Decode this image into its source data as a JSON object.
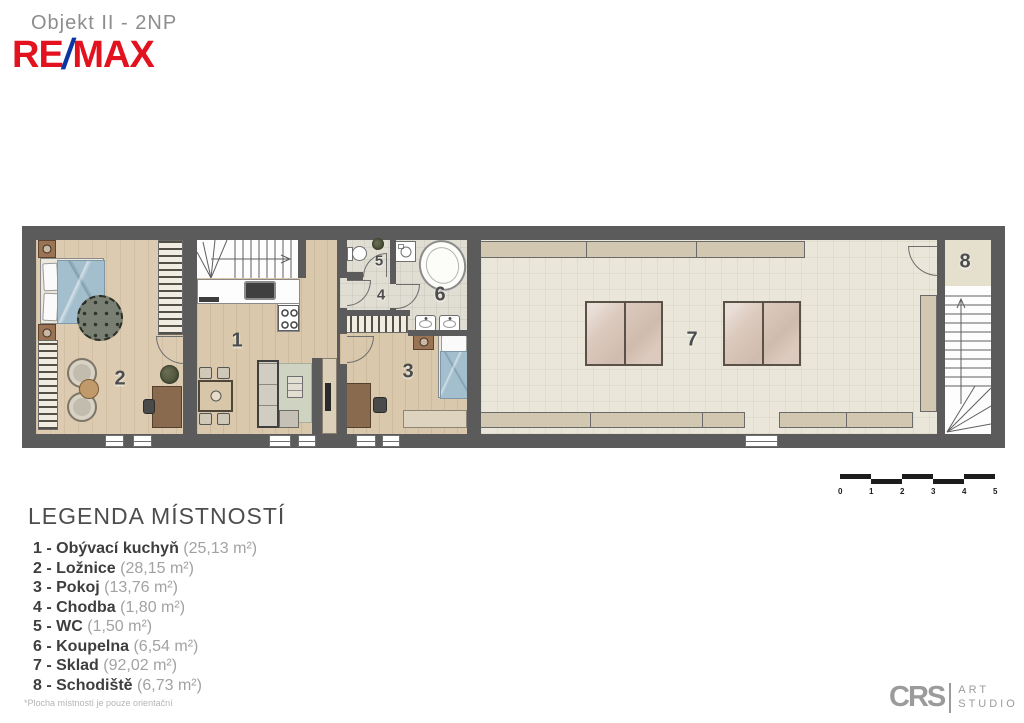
{
  "header": {
    "title": "Objekt II - 2NP",
    "brand": {
      "re": "RE",
      "slash": "/",
      "max": "MAX"
    }
  },
  "rooms": [
    {
      "number": "1"
    },
    {
      "number": "2"
    },
    {
      "number": "3"
    },
    {
      "number": "4"
    },
    {
      "number": "5"
    },
    {
      "number": "6"
    },
    {
      "number": "7"
    },
    {
      "number": "8"
    }
  ],
  "legend": {
    "heading": "LEGENDA MÍSTNOSTÍ",
    "items": [
      {
        "label": "1 - Obývací kuchyň",
        "area": "(25,13 m²)"
      },
      {
        "label": "2 - Ložnice",
        "area": "(28,15 m²)"
      },
      {
        "label": "3 - Pokoj",
        "area": "(13,76 m²)"
      },
      {
        "label": "4 - Chodba",
        "area": "(1,80 m²)"
      },
      {
        "label": "5 - WC",
        "area": "(1,50 m²)"
      },
      {
        "label": "6 - Koupelna",
        "area": "(6,54 m²)"
      },
      {
        "label": "7 - Sklad",
        "area": "(92,02 m²)"
      },
      {
        "label": "8 - Schodiště",
        "area": "(6,73 m²)"
      }
    ],
    "footnote": "*Plocha místností je pouze orientační"
  },
  "scalebar": {
    "labels": [
      "0",
      "1",
      "2",
      "3",
      "4",
      "5"
    ]
  },
  "credit": {
    "brand": "CRS",
    "line1": "ART",
    "line2": "STUDIO"
  },
  "colors": {
    "remax_red": "#e2131e",
    "remax_blue": "#0b35a0",
    "wall": "#5b5b5b",
    "wood_floor": "#d9c8ab",
    "tile_floor": "#e0ddd2",
    "storage_floor": "#eae7da",
    "bed_blue": "#a3becd",
    "shelf_tan": "#d2c7b0",
    "text_dark": "#3e3e3e",
    "text_light": "#a2a2a2"
  }
}
